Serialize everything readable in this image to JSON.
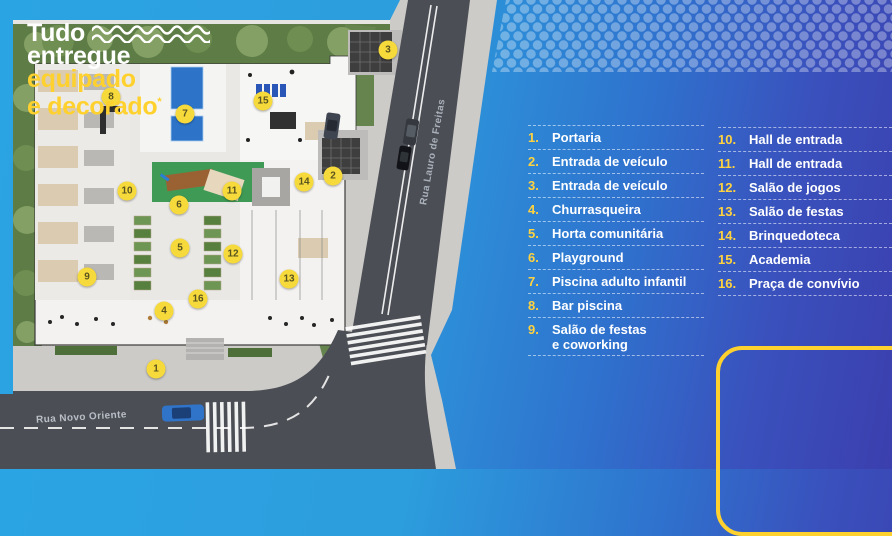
{
  "legend": {
    "left": [
      {
        "num": "1.",
        "label": "Portaria"
      },
      {
        "num": "2.",
        "label": "Entrada de veículo"
      },
      {
        "num": "3.",
        "label": "Entrada de veículo"
      },
      {
        "num": "4.",
        "label": "Churrasqueira"
      },
      {
        "num": "5.",
        "label": "Horta comunitária"
      },
      {
        "num": "6.",
        "label": "Playground"
      },
      {
        "num": "7.",
        "label": "Piscina adulto infantil"
      },
      {
        "num": "8.",
        "label": "Bar piscina"
      },
      {
        "num": "9.",
        "label": "Salão de festas\ne coworking"
      }
    ],
    "right": [
      {
        "num": "10.",
        "label": "Hall de entrada"
      },
      {
        "num": "11.",
        "label": "Hall de entrada"
      },
      {
        "num": "12.",
        "label": "Salão de jogos"
      },
      {
        "num": "13.",
        "label": "Salão de festas"
      },
      {
        "num": "14.",
        "label": "Brinquedoteca"
      },
      {
        "num": "15.",
        "label": "Academia"
      },
      {
        "num": "16.",
        "label": "Praça de convívio"
      }
    ]
  },
  "promo": {
    "line1": "Tudo",
    "line2": "entregue",
    "line3": "equipado",
    "line4": "e decorado",
    "sup": "*"
  },
  "map": {
    "streets": {
      "bottom": "Rua Novo Oriente",
      "diagonal": "Rua Lauro de Freitas"
    },
    "markers": [
      {
        "n": "1",
        "x": 156,
        "y": 369
      },
      {
        "n": "2",
        "x": 333,
        "y": 176
      },
      {
        "n": "3",
        "x": 388,
        "y": 50
      },
      {
        "n": "4",
        "x": 164,
        "y": 311
      },
      {
        "n": "5",
        "x": 180,
        "y": 248
      },
      {
        "n": "6",
        "x": 179,
        "y": 205
      },
      {
        "n": "7",
        "x": 185,
        "y": 114
      },
      {
        "n": "8",
        "x": 111,
        "y": 97
      },
      {
        "n": "9",
        "x": 87,
        "y": 277
      },
      {
        "n": "10",
        "x": 127,
        "y": 191
      },
      {
        "n": "11",
        "x": 232,
        "y": 191
      },
      {
        "n": "12",
        "x": 233,
        "y": 254
      },
      {
        "n": "13",
        "x": 289,
        "y": 279
      },
      {
        "n": "14",
        "x": 304,
        "y": 182
      },
      {
        "n": "15",
        "x": 263,
        "y": 101
      },
      {
        "n": "16",
        "x": 198,
        "y": 299
      }
    ]
  },
  "colors": {
    "panel_blue_light": "#2ba4e4",
    "panel_blue_dark": "#3b3fae",
    "accent_yellow": "#ffd12e",
    "legend_number_yellow": "#ffd23f",
    "marker_yellow": "#f6d93b",
    "pool_blue": "#2d74c8",
    "grass_green": "#5d7c46",
    "playground_green": "#3f9a55",
    "road_gray": "#4b4e54"
  }
}
